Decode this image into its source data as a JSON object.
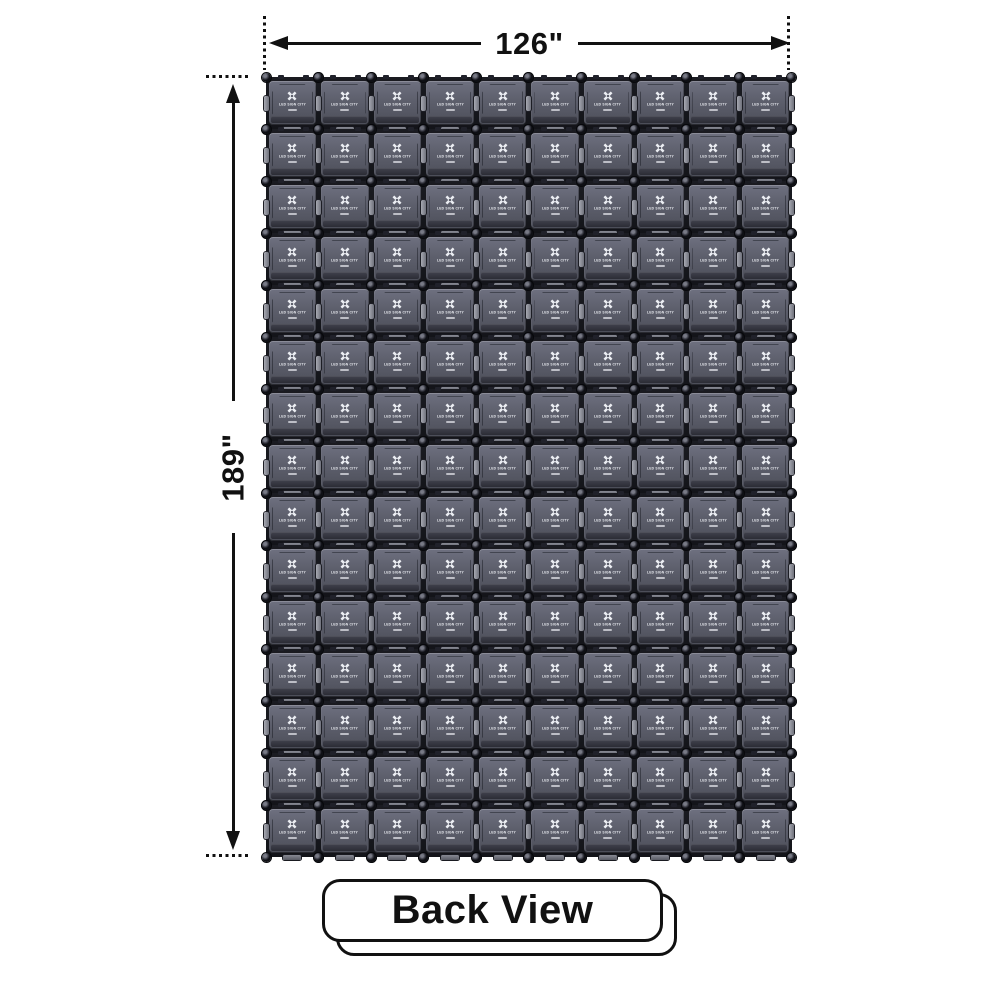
{
  "diagram": {
    "width_dimension": {
      "label": "126\""
    },
    "height_dimension": {
      "label": "189\""
    },
    "view_badge": {
      "label": "Back View"
    },
    "panel_grid": {
      "rows": 15,
      "columns": 10,
      "panel_count": 150,
      "panel_brand": "LED SIGN CITY"
    },
    "colors": {
      "background": "#ffffff",
      "dimension_lines": "#111111",
      "panel_face": "#5d5f6c",
      "panel_seam": "#17181d",
      "hardware_highlight": "#a7a9b2",
      "badge_border": "#111111",
      "badge_background": "#ffffff",
      "logo_color": "#eceef3"
    }
  }
}
